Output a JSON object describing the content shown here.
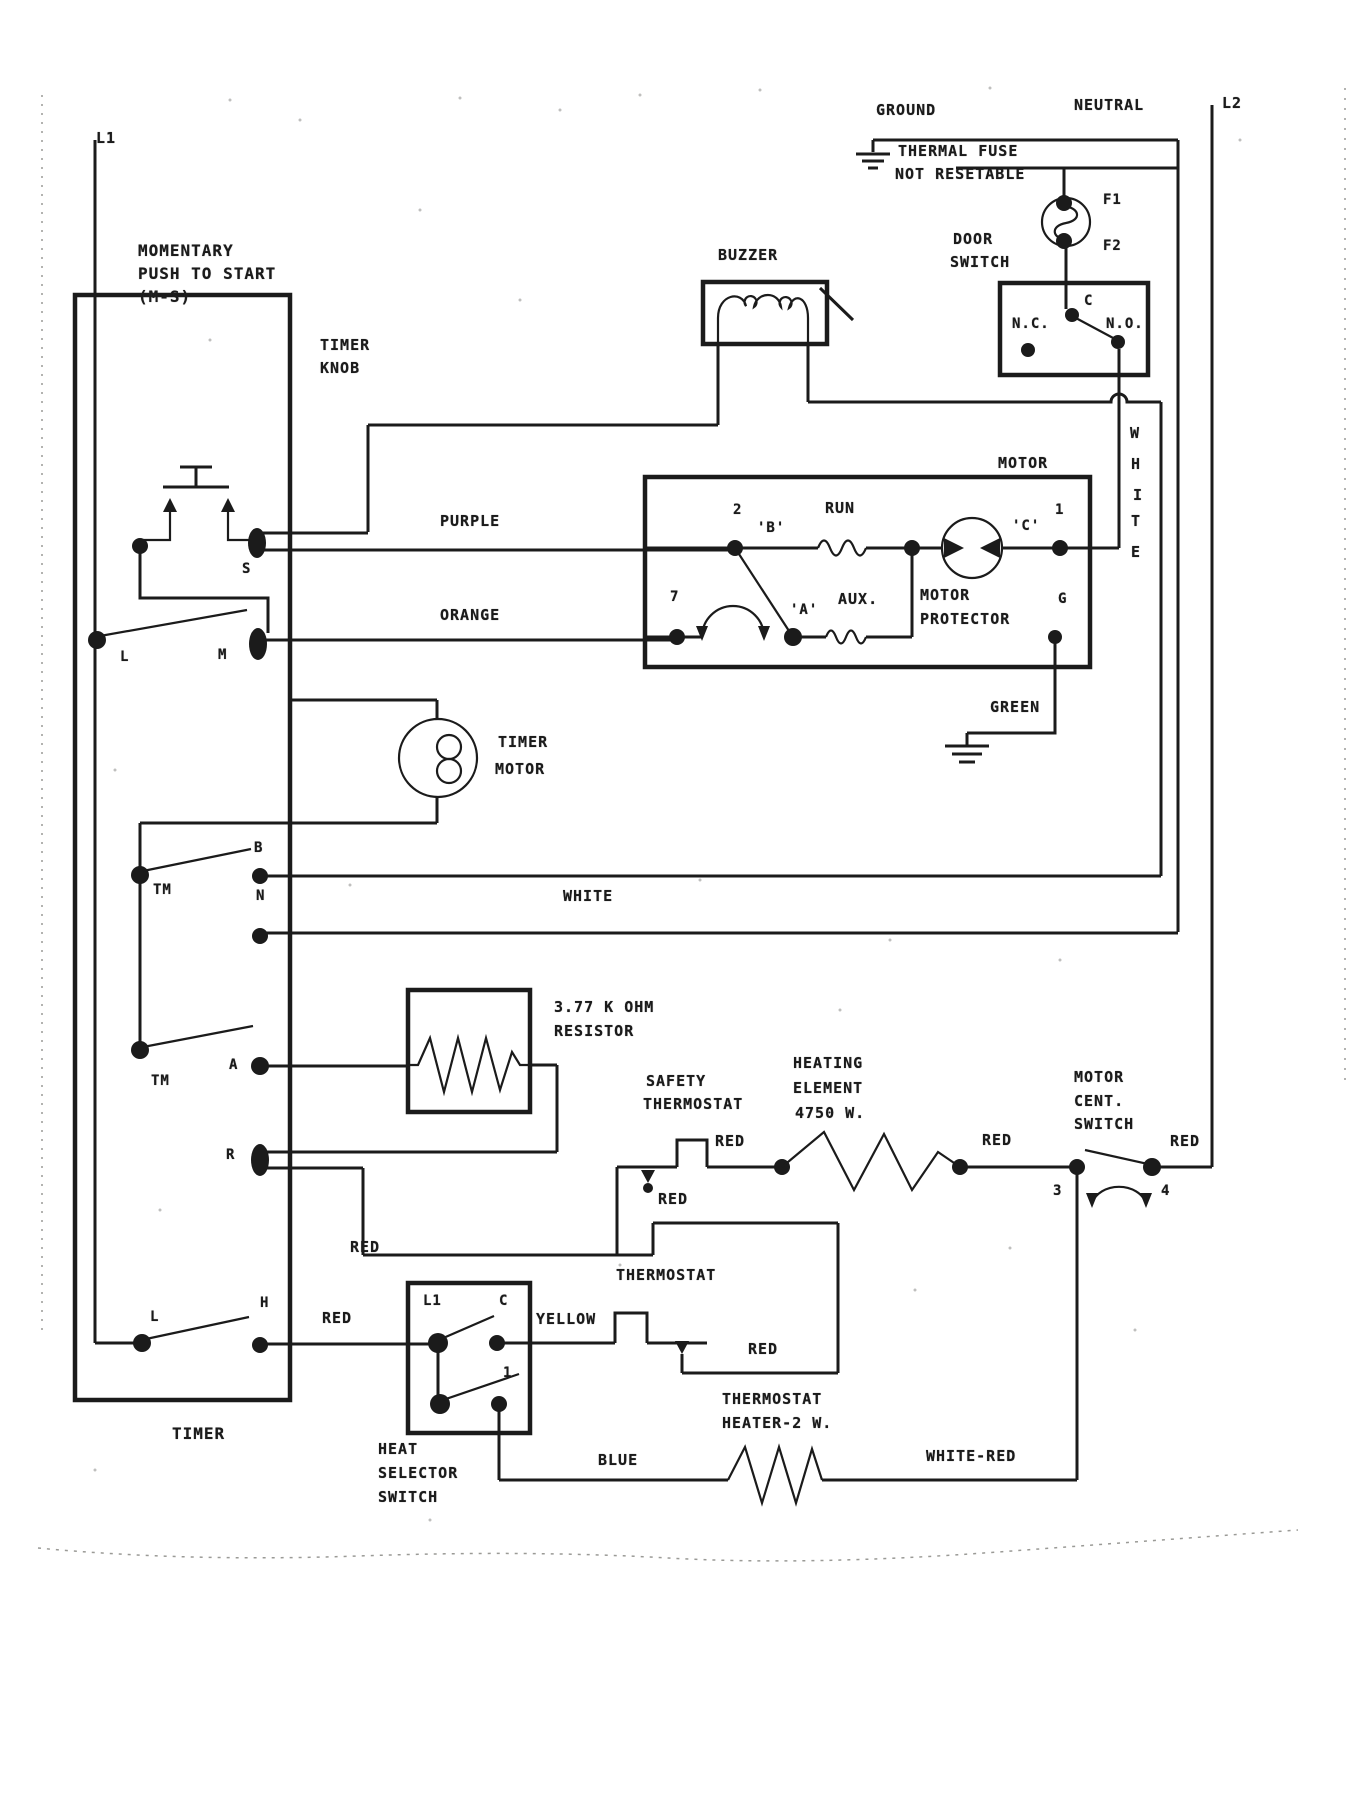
{
  "power": {
    "l1": "L1",
    "l2": "L2",
    "ground": "GROUND",
    "neutral": "NEUTRAL"
  },
  "thermal_fuse": {
    "line1": "THERMAL FUSE",
    "line2": "NOT RESETABLE",
    "f1": "F1",
    "f2": "F2"
  },
  "door_switch": {
    "label1": "DOOR",
    "label2": "SWITCH",
    "nc": "N.C.",
    "c": "C",
    "no": "N.O."
  },
  "buzzer": {
    "label": "BUZZER"
  },
  "momentary": {
    "line1": "MOMENTARY",
    "line2": "PUSH TO START",
    "line3": "(M-S)"
  },
  "timer": {
    "knob1": "TIMER",
    "knob2": "KNOB",
    "label": "TIMER",
    "contacts": {
      "s": "S",
      "l_mid": "L",
      "m": "M",
      "tm1": "TM",
      "b": "B",
      "n": "N",
      "tm2": "TM",
      "a": "A",
      "r": "R",
      "l_bot": "L",
      "h": "H"
    }
  },
  "timer_motor": {
    "line1": "TIMER",
    "line2": "MOTOR"
  },
  "motor": {
    "label": "MOTOR",
    "run": "RUN",
    "aux": "AUX.",
    "protector1": "MOTOR",
    "protector2": "PROTECTOR",
    "t2": "2",
    "t1": "1",
    "t7": "7",
    "a": "'A'",
    "b": "'B'",
    "c": "'C'",
    "g": "G"
  },
  "wires": {
    "purple": "PURPLE",
    "orange": "ORANGE",
    "white": "WHITE",
    "white_v": [
      "W",
      "H",
      "I",
      "T",
      "E"
    ],
    "green": "GREEN",
    "red": "RED",
    "yellow": "YELLOW",
    "blue": "BLUE",
    "white_red": "WHITE-RED"
  },
  "resistor": {
    "line1": "3.77 K OHM",
    "line2": "RESISTOR"
  },
  "safety_thermostat": {
    "line1": "SAFETY",
    "line2": "THERMOSTAT"
  },
  "heating_element": {
    "line1": "HEATING",
    "line2": "ELEMENT",
    "line3": "4750 W."
  },
  "motor_cent_switch": {
    "line1": "MOTOR",
    "line2": "CENT.",
    "line3": "SWITCH",
    "t3": "3",
    "t4": "4"
  },
  "thermostat": {
    "label": "THERMOSTAT"
  },
  "heat_selector": {
    "line1": "HEAT",
    "line2": "SELECTOR",
    "line3": "SWITCH",
    "l1": "L1",
    "c": "C",
    "t1": "1"
  },
  "thermostat_heater": {
    "line1": "THERMOSTAT",
    "line2": "HEATER-2 W."
  },
  "colors": {
    "ink": "#1b1b1b",
    "paper": "#ffffff"
  }
}
